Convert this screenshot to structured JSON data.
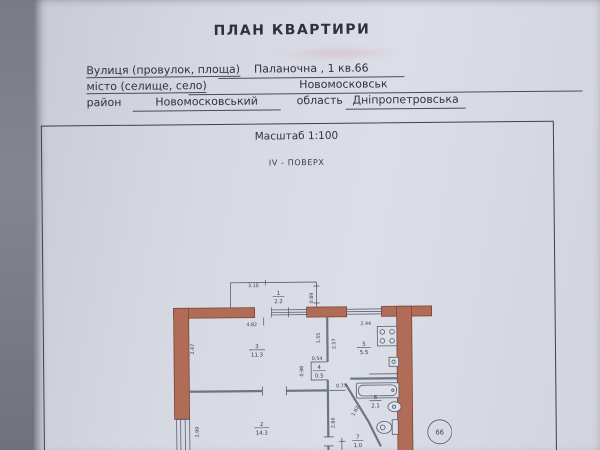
{
  "document": {
    "title": "ПЛАН КВАРТИРИ",
    "fields": {
      "street_label": "Вулиця (провулок, площа)",
      "street_value": "Паланочна ,  1 кв.66",
      "city_label": "місто (селище, село)",
      "city_value": "Новомосковськ",
      "district_label": "район",
      "district_value": "Новомосковський",
      "region_label": "область",
      "region_value": "Дніпропетровська"
    },
    "scale_text": "Масштаб 1:100",
    "floor_text": "IV - ПОВЕРХ",
    "apartment_badge": "66"
  },
  "plan": {
    "rooms": {
      "r1": {
        "num": "1",
        "area": "2.2"
      },
      "r2": {
        "num": "2",
        "area": "14.3"
      },
      "r3": {
        "num": "3",
        "area": "11.3"
      },
      "r4": {
        "num": "4",
        "area": "0.5"
      },
      "r5": {
        "num": "5",
        "area": "5.5"
      },
      "r6": {
        "num": "6",
        "area": "2.1"
      },
      "r7": {
        "num": "7",
        "area": "1.0"
      }
    },
    "dims": {
      "balcony_width": "3.10",
      "balcony_depth": "0.89",
      "room3_width": "4.82",
      "kitchen_width": "2.44",
      "room3_depth": "2.47",
      "hall_seg": "1.55",
      "kitchen_depth": "2.57",
      "closet_width": "0.54",
      "closet_depth": "0.98",
      "hall_opening": "0.77",
      "bath_wall": "1.62",
      "room2_depth": "2.86",
      "room2_window": "2.99"
    },
    "colors": {
      "wall_fill": "#b16c57",
      "wall_stroke": "#7a4334",
      "paper": "#d5d8e1",
      "line": "#4a5066"
    }
  }
}
